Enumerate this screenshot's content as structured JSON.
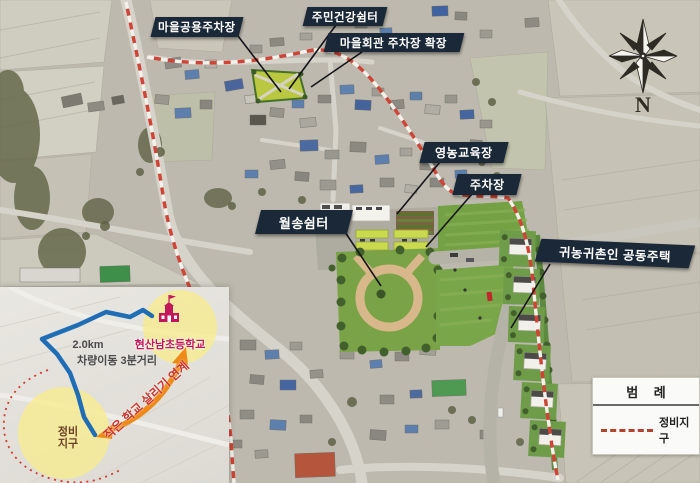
{
  "callouts": {
    "village_public_parking": "마을공용주차장",
    "resident_health_shelter": "주민건강쉼터",
    "village_hall_parking_expansion": "마을회관 주차장 확장",
    "farming_education_center": "영농교육장",
    "parking_lot": "주차장",
    "wolsong_shelter": "월송쉼터",
    "communal_housing": "귀농귀촌인 공동주택"
  },
  "legend": {
    "title": "범 례",
    "items": [
      {
        "symbol": "red-dashed-line",
        "color": "#b5432f",
        "label": "정비지구"
      }
    ]
  },
  "compass": {
    "north_label": "N"
  },
  "inset": {
    "school": {
      "icon": "school-icon",
      "name": "현산남초등학교"
    },
    "distance": {
      "line1": "2.0km",
      "line2": "차량이동 3분거리"
    },
    "district": {
      "line1": "정비",
      "line2": "지구"
    },
    "arrow_label": "작은 학교 살리기 연계"
  },
  "colors": {
    "callout_bg": "#1b2838",
    "boundary_red": "#cf4436",
    "route_blue": "#1e6db5",
    "arrow_orange": "#ef8a1a",
    "school_magenta": "#c2185b",
    "highlight_yellow": "#f7ec8e",
    "park_green": "#7aa348",
    "legend_dash": "#b5432f"
  }
}
